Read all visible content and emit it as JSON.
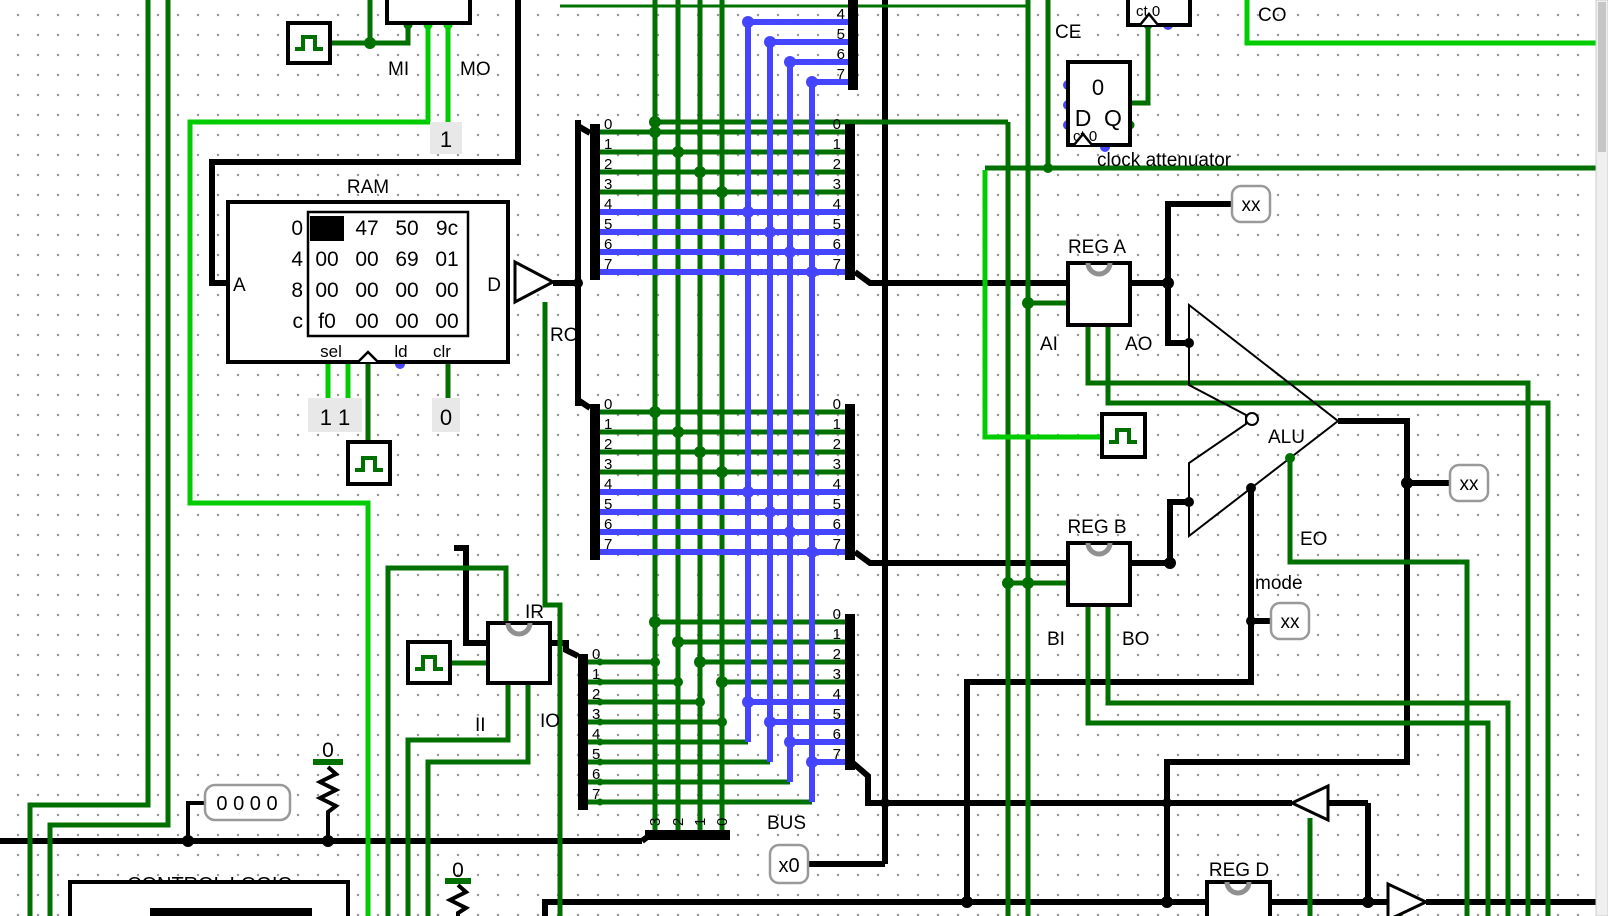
{
  "colors": {
    "dark_green": "#007000",
    "bright_green": "#00CC00",
    "blue": "#4545FF",
    "wire_black": "#000000",
    "gray_text": "#808080",
    "value_bg": "#E8E8E8",
    "probe_border": "#999999",
    "arc_gray": "#909090"
  },
  "ram": {
    "label": "RAM",
    "port_a": "A",
    "port_d": "D",
    "port_sel": "sel",
    "port_ld": "ld",
    "port_clr": "clr",
    "addresses": [
      "0",
      "4",
      "8",
      "c"
    ],
    "rows": [
      [
        "36",
        "47",
        "50",
        "9c"
      ],
      [
        "00",
        "00",
        "69",
        "01"
      ],
      [
        "00",
        "00",
        "00",
        "00"
      ],
      [
        "f0",
        "00",
        "00",
        "00"
      ]
    ],
    "sel_value": "1 1",
    "clr_value": "0"
  },
  "mar": {
    "mi": "MI",
    "mo": "MO",
    "mo_value": "1"
  },
  "bus": {
    "ro": "RO",
    "bus_label": "BUS",
    "pins": [
      "0",
      "1",
      "2",
      "3",
      "4",
      "5",
      "6",
      "7"
    ],
    "top_pins": [
      "4",
      "5",
      "6",
      "7"
    ],
    "nibble_pins": [
      "3",
      "2",
      "1",
      "0"
    ]
  },
  "registers": {
    "reg_a": "REG A",
    "ai": "AI",
    "ao": "AO",
    "reg_b": "REG B",
    "bi": "BI",
    "bo": "BO",
    "reg_d": "REG D",
    "ir": "IR",
    "ii": "II",
    "io": "IO"
  },
  "alu": {
    "label": "ALU",
    "eo": "EO",
    "mode": "mode"
  },
  "probes": {
    "xx_a": "xx",
    "xx_alu": "xx",
    "xx_mode": "xx",
    "x0": "x0",
    "control_word": "0 0 0 0"
  },
  "counter": {
    "ce": "CE",
    "ct0_top": "ct 0",
    "ct0_ff": "ct 0",
    "ff_value": "0",
    "ff_d": "D",
    "ff_q": "Q",
    "attenuator": "clock attenuator",
    "co": "CO"
  },
  "control": {
    "label": "CONTROL LOGIC",
    "pull1": "0",
    "pull2": "0"
  }
}
